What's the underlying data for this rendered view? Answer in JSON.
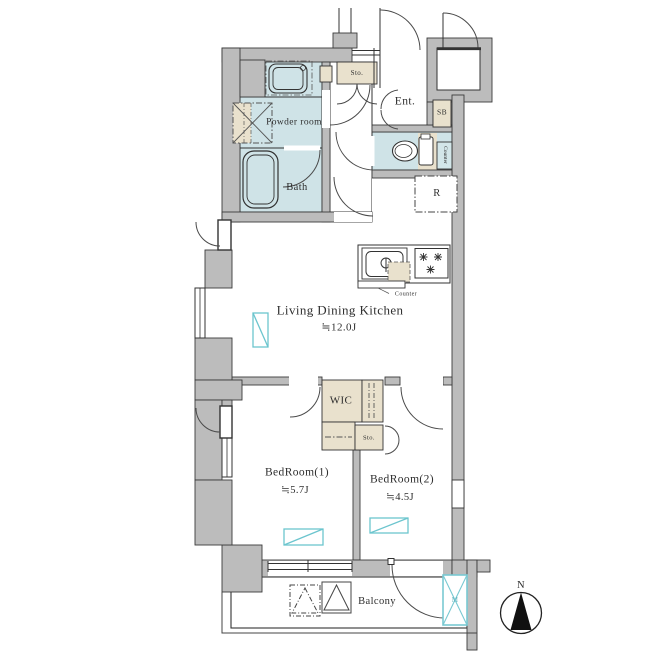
{
  "title": "Apartment floor plan",
  "colors": {
    "wall": "#bcbcbc",
    "wet_room_fill": "#cfe3e7",
    "storage_fill": "#e9e1cd",
    "accent_cyan": "#6cc5ce",
    "line": "#333333"
  },
  "rooms": {
    "powder_room": {
      "label": "Powder room"
    },
    "bath": {
      "label": "Bath"
    },
    "entrance": {
      "label": "Ent."
    },
    "shoe_box": {
      "label": "SB"
    },
    "storage_top": {
      "label": "Sto."
    },
    "toilet_counter": {
      "label": "Counter"
    },
    "refrigerator": {
      "label": "R"
    },
    "kitchen_counter": {
      "label": "Counter"
    },
    "ldk": {
      "label": "Living Dining Kitchen",
      "size": "≒12.0J"
    },
    "wic": {
      "label": "WIC"
    },
    "storage_wic": {
      "label": "Sto."
    },
    "bedroom1": {
      "label": "BedRoom(1)",
      "size": "≒5.7J"
    },
    "bedroom2": {
      "label": "BedRoom(2)",
      "size": "≒4.5J"
    },
    "balcony": {
      "label": "Balcony"
    },
    "meter_box": {
      "label": "M"
    }
  },
  "compass": {
    "label": "N"
  }
}
